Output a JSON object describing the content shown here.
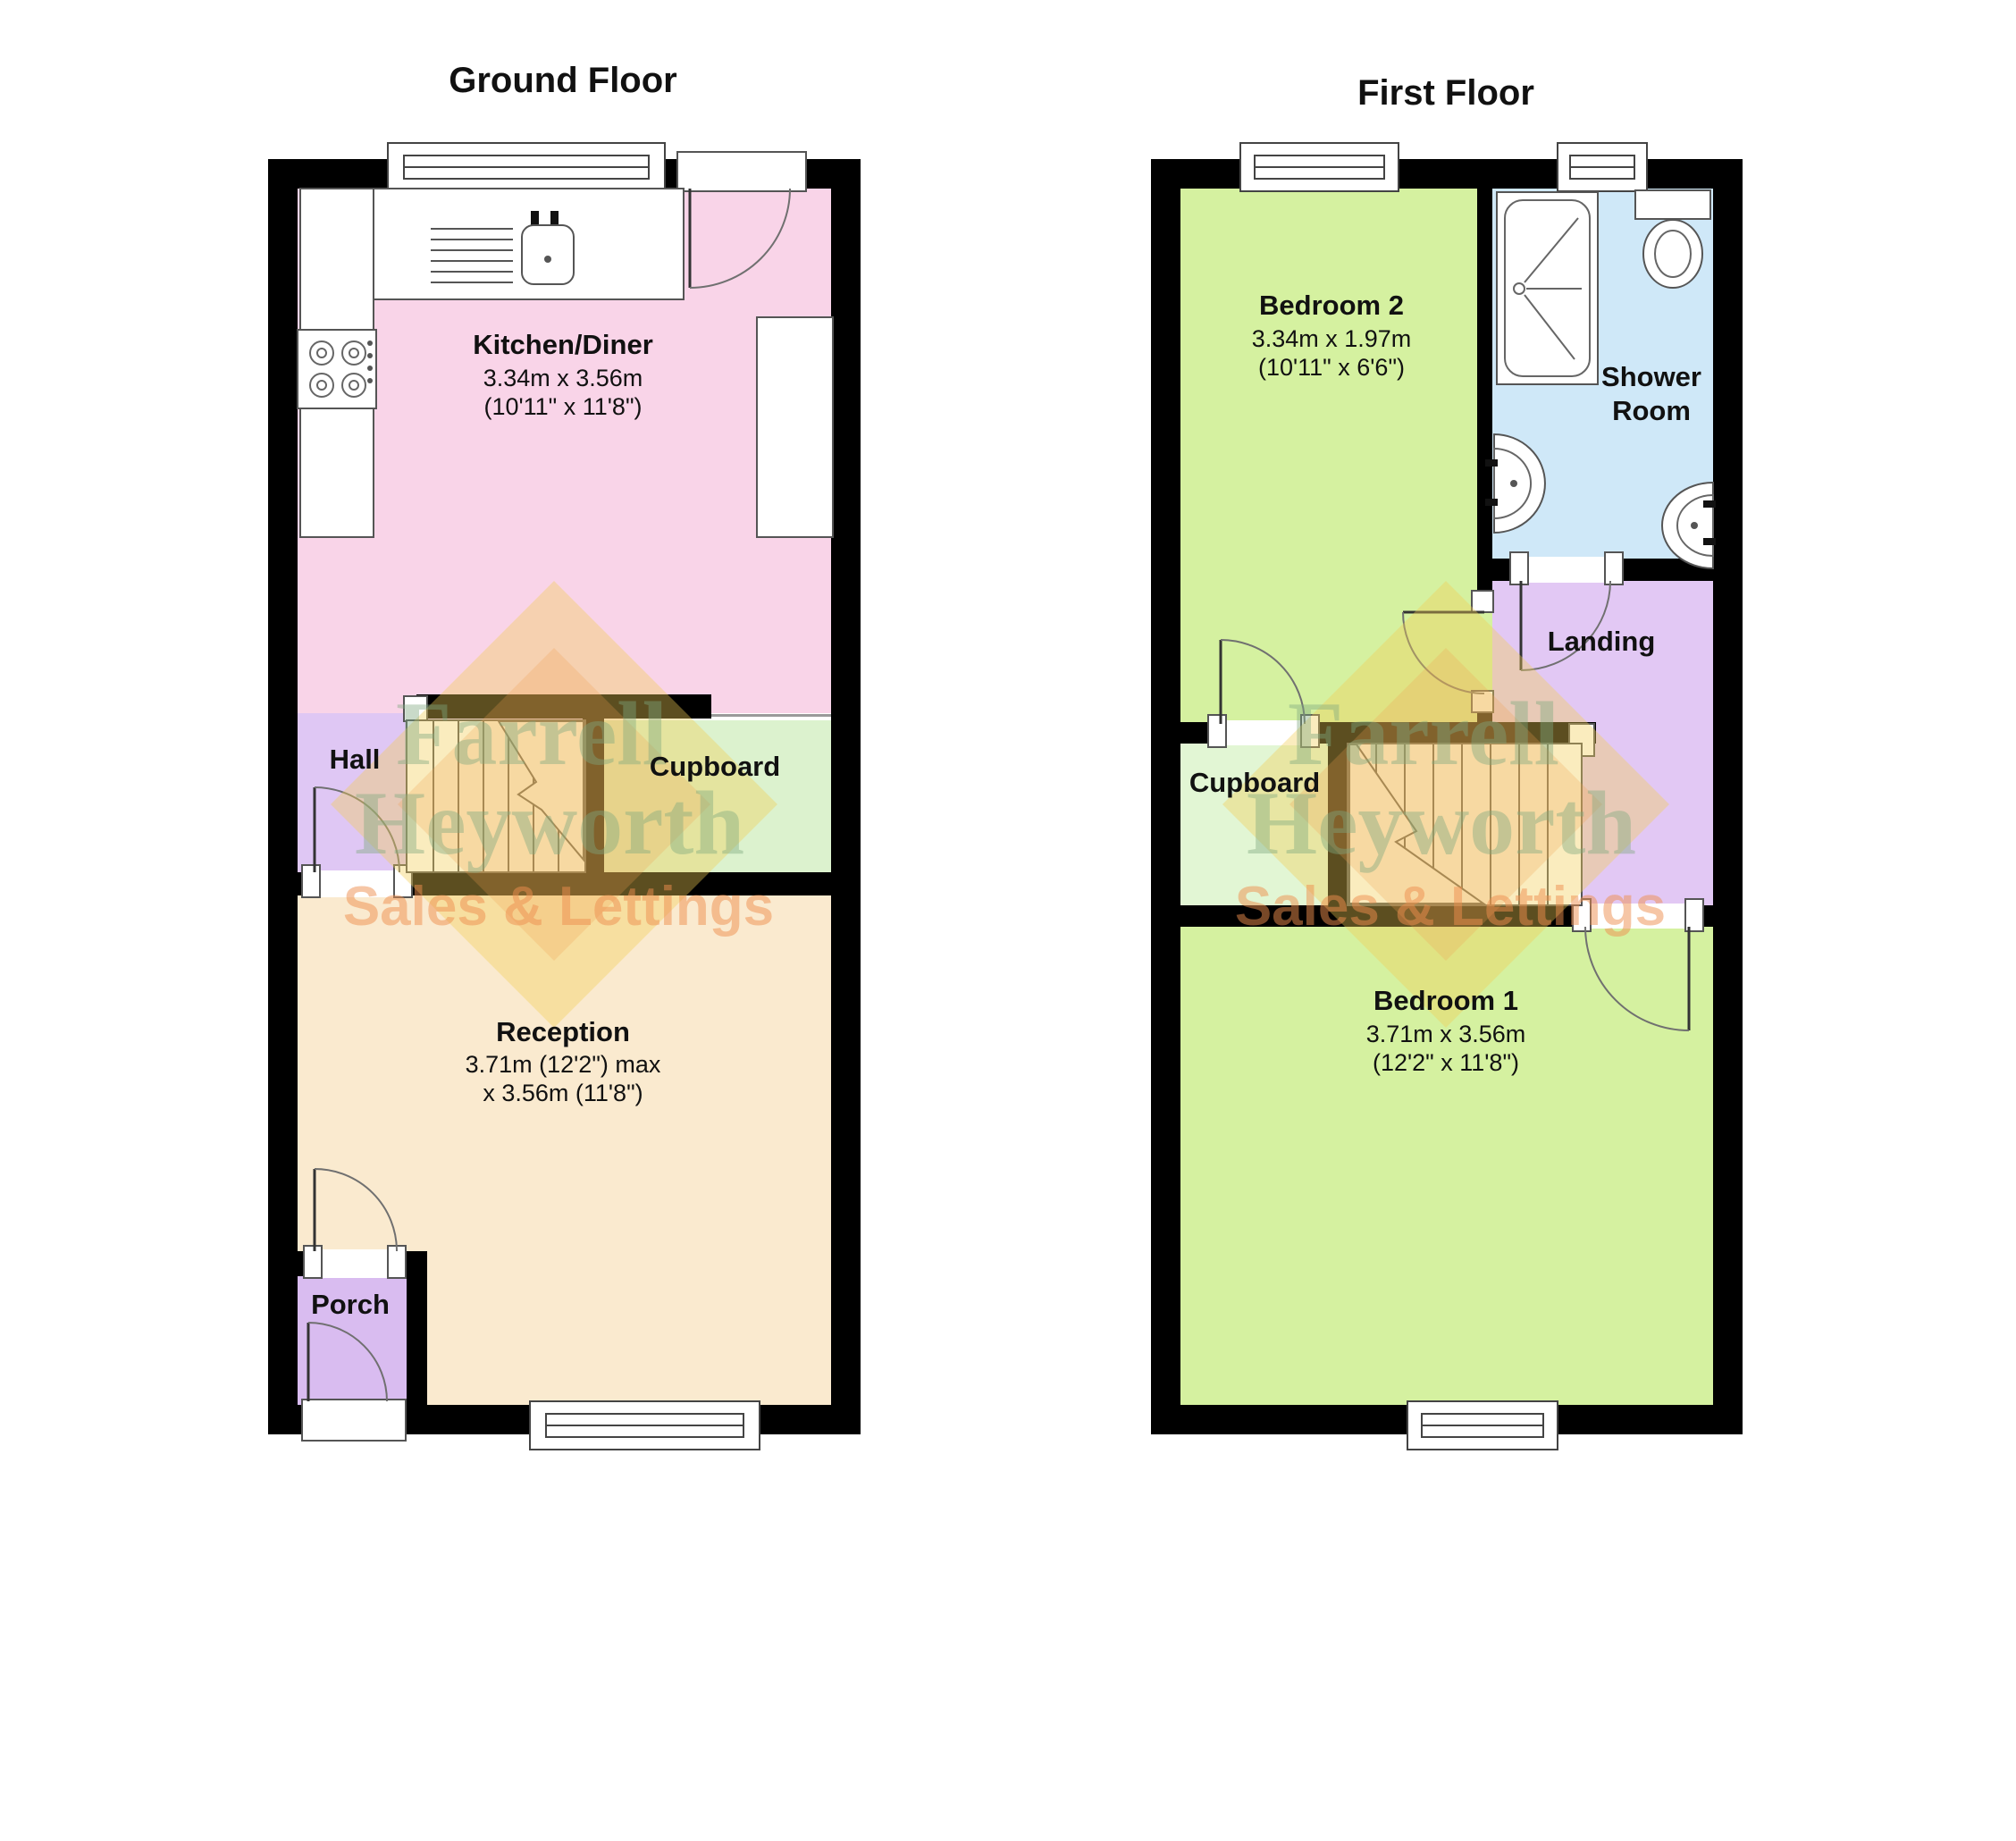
{
  "ground_floor": {
    "title": "Ground Floor",
    "rooms": {
      "kitchen": {
        "name": "Kitchen/Diner",
        "dim1": "3.34m x 3.56m",
        "dim2": "(10'11\" x 11'8\")"
      },
      "hall": {
        "name": "Hall"
      },
      "cupboard": {
        "name": "Cupboard"
      },
      "reception": {
        "name": "Reception",
        "dim1": "3.71m (12'2\") max",
        "dim2": "x 3.56m (11'8\")"
      },
      "porch": {
        "name": "Porch"
      }
    }
  },
  "first_floor": {
    "title": "First Floor",
    "rooms": {
      "bedroom2": {
        "name": "Bedroom 2",
        "dim1": "3.34m x 1.97m",
        "dim2": "(10'11\" x 6'6\")"
      },
      "shower_room": {
        "name1": "Shower",
        "name2": "Room"
      },
      "landing": {
        "name": "Landing"
      },
      "cupboard": {
        "name": "Cupboard"
      },
      "bedroom1": {
        "name": "Bedroom 1",
        "dim1": "3.71m x 3.56m",
        "dim2": "(12'2\" x 11'8\")"
      }
    }
  },
  "watermark": {
    "line1": "Farrell",
    "line2": "Heyworth",
    "line3": "Sales & Lettings",
    "diamond_color": "#F2CC55",
    "diamond_accent_color": "#EE9E4E",
    "name_color": "#7FA97F",
    "tagline_color": "#EF8F4F"
  },
  "colors": {
    "wall": "#000000",
    "kitchen": "#F9D4E8",
    "reception": "#FAEACF",
    "hall": "#DFC7F4",
    "porch": "#D9BCF0",
    "cupboard_ground": "#DCF2CE",
    "bedroom": "#D5F1A0",
    "shower": "#CFE8F8",
    "landing": "#E2C8F4",
    "cupboard_first": "#E2F6D4"
  }
}
